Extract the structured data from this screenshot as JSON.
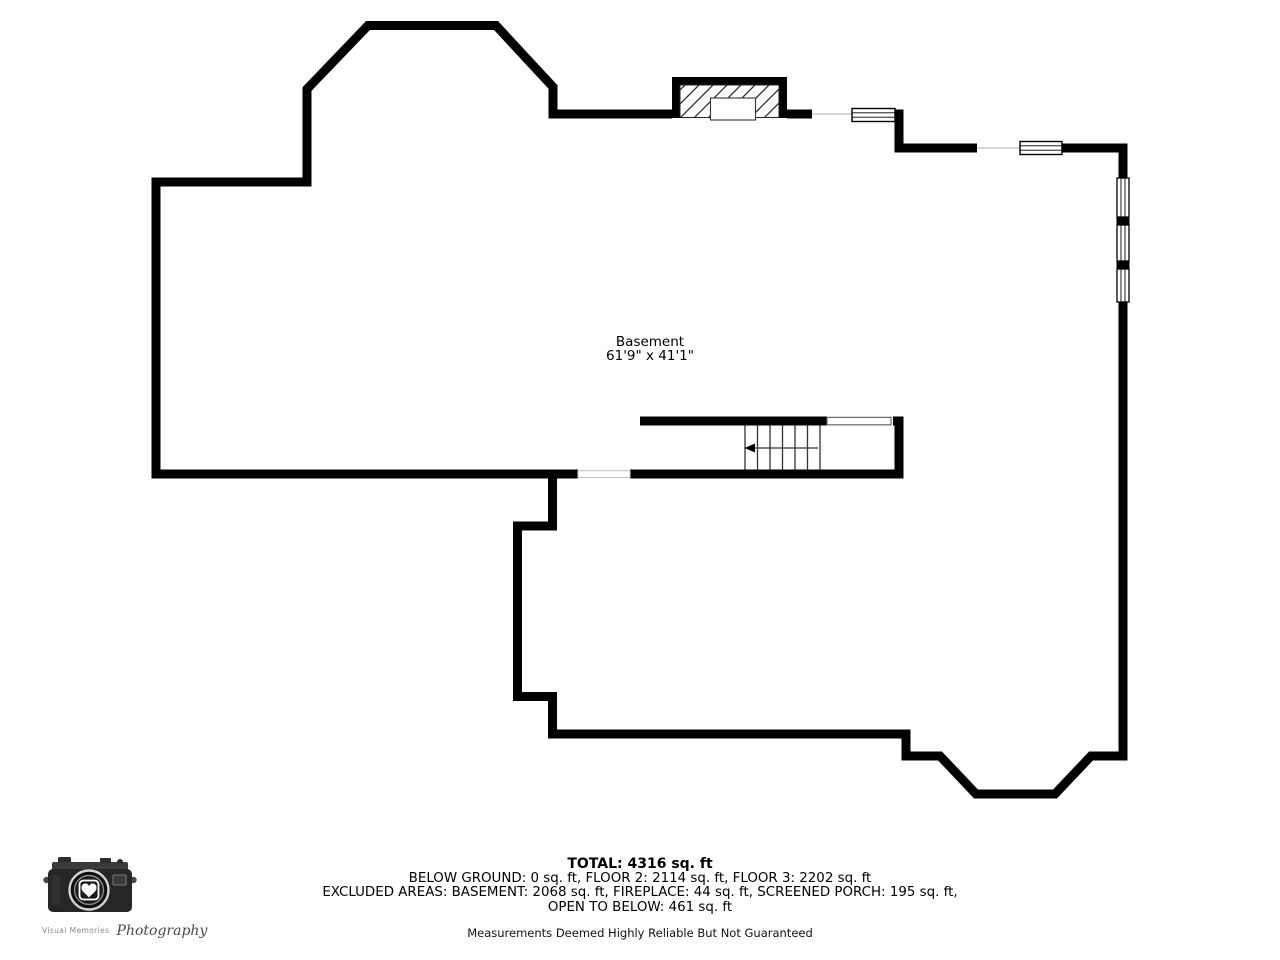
{
  "plan": {
    "room_label": "Basement",
    "room_dimensions": "61'9\" x 41'1\""
  },
  "summary": {
    "total": "TOTAL: 4316 sq. ft",
    "line1": "BELOW GROUND: 0 sq. ft, FLOOR 2: 2114 sq. ft, FLOOR 3: 2202 sq. ft",
    "line2": "EXCLUDED AREAS: BASEMENT: 2068 sq. ft, FIREPLACE: 44 sq. ft, SCREENED PORCH: 195 sq. ft,",
    "line3": "OPEN TO BELOW: 461 sq. ft",
    "disclaimer": "Measurements Deemed Highly Reliable But Not Guaranteed"
  },
  "logo": {
    "name": "Visual Memories",
    "script": "Photography"
  },
  "icons": {
    "stair_direction_arrow": "left",
    "logo_icon": "camera-with-heart"
  },
  "colors": {
    "wall": "#000000",
    "background": "#ffffff",
    "stair_line": "#333333",
    "opening_line": "#c8c8c8"
  }
}
